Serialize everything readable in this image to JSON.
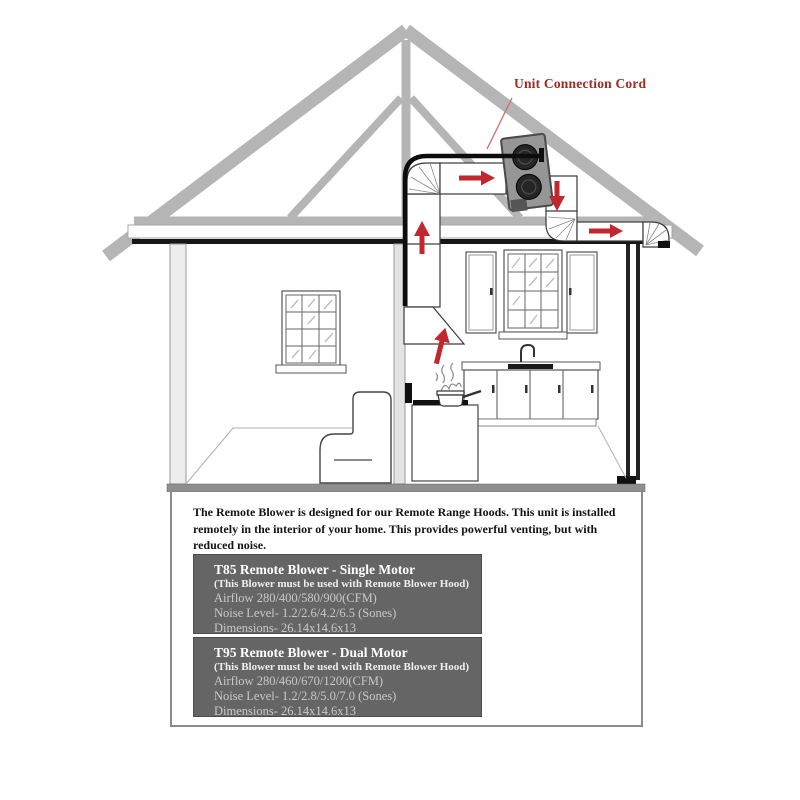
{
  "diagram": {
    "cord_label": "Unit Connection Cord",
    "colors": {
      "arrow_red": "#c1272d",
      "label_red": "#9c2b22",
      "spec_box_gray": "#656565",
      "truss_gray": "#b5b5b5"
    },
    "flow_arrows": [
      "up-into-duct",
      "right-along-attic-duct",
      "down-from-blower",
      "right-to-exterior-vent",
      "up-into-range-hood"
    ]
  },
  "info_panel": {
    "intro_lines": [
      "The Remote Blower is designed for our Remote Range Hoods.  This unit is installed",
      "remotely in the interior of your home.  This provides powerful venting, but with",
      "reduced noise."
    ],
    "products": [
      {
        "title": "T85 Remote Blower - Single Motor",
        "note": "(This Blower must be used with Remote Blower Hood)",
        "airflow": "Airflow 280/400/580/900(CFM)",
        "noise": "Noise Level- 1.2/2.6/4.2/6.5 (Sones)",
        "dimensions": "Dimensions- 26.14x14.6x13"
      },
      {
        "title": "T95 Remote Blower - Dual Motor",
        "note": "(This Blower must be used with Remote Blower Hood)",
        "airflow": "Airflow 280/460/670/1200(CFM)",
        "noise": "Noise Level- 1.2/2.8/5.0/7.0 (Sones)",
        "dimensions": "Dimensions- 26.14x14.6x13"
      }
    ]
  }
}
